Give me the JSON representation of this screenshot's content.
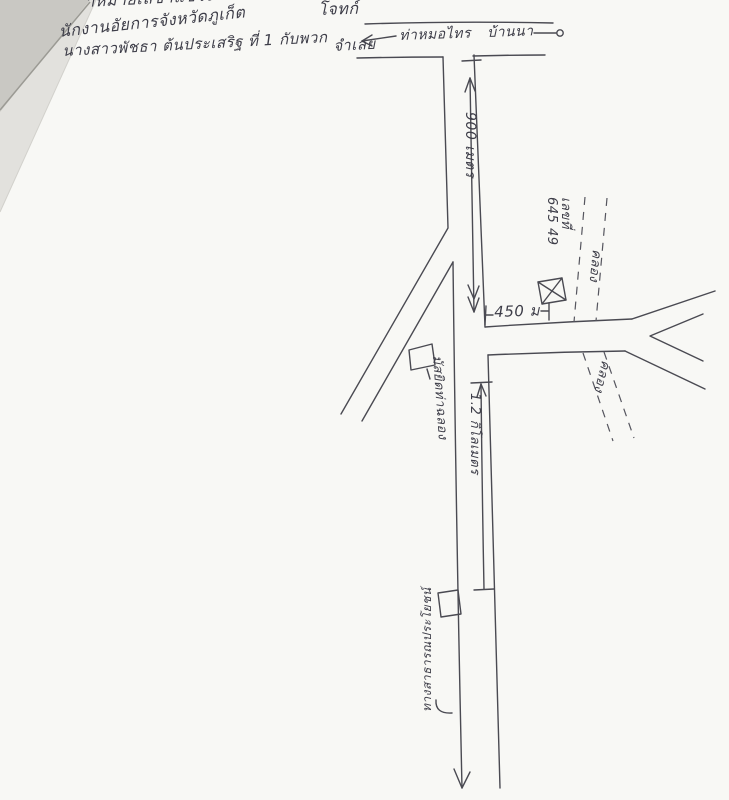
{
  "header": {
    "line1": "าหมายเลขาแขวงฯ",
    "plaintiff": "โจทก์",
    "line2": "นักงานอัยการจังหวัดภูเก็ต",
    "line3": "นางสาวพัชธา ต้นประเสริฐ ที่ 1 กับพวก",
    "defendant": "จำเลย"
  },
  "map": {
    "roads": {
      "top_left_destination": "ท่าหมอไทร",
      "top_right_destination": "บ้านนา"
    },
    "distances": {
      "north_segment": "900 เมตร",
      "east_segment": "450 ม",
      "south_segment": "1.2 กิโลเมตร"
    },
    "parcel": {
      "label_line1": "เลขที่",
      "label_line2": "645 49"
    },
    "canal": {
      "label_upper": "คลอง",
      "label_lower": "คลอง"
    },
    "mosque_label": "มัสยิดท่าฉลอง",
    "south_road_label": "ทางสาธารณประโยชน์"
  },
  "colors": {
    "ink": "#44444e",
    "paper": "#f8f8f5",
    "fold_shadow": "#c9c8c3"
  }
}
